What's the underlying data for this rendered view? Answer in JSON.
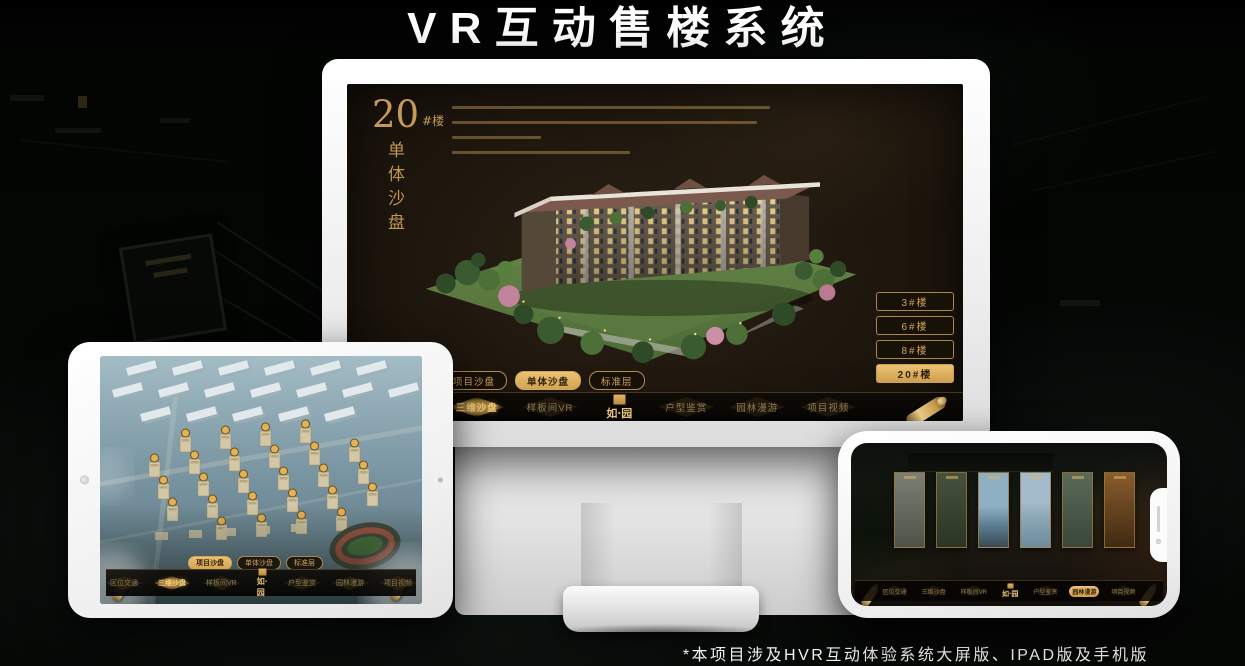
{
  "title": "VR互动售楼系统",
  "footnote": "*本项目涉及HVR互动体验系统大屏版、IPAD版及手机版",
  "logo_text": "如·园",
  "accent_color": "#d2a659",
  "icons": {
    "nav_end": "scroll-icon",
    "brand": "seal-icon",
    "tablet_front": "camera-icon",
    "phone_notch": "speaker-and-camera"
  },
  "monitor": {
    "headline_number": "20",
    "headline_unit": "#楼",
    "headline_subtitle": "单体沙盘",
    "floor_buttons": [
      {
        "label": "3#楼",
        "selected": false
      },
      {
        "label": "6#楼",
        "selected": false
      },
      {
        "label": "8#楼",
        "selected": false
      },
      {
        "label": "20#楼",
        "selected": true
      }
    ],
    "sub_tabs": [
      {
        "label": "项目沙盘",
        "selected": false
      },
      {
        "label": "单体沙盘",
        "selected": true
      },
      {
        "label": "标准层",
        "selected": false
      }
    ],
    "nav_left": [
      {
        "label": "区位交通",
        "selected": false
      },
      {
        "label": "三维沙盘",
        "selected": true
      },
      {
        "label": "样板间VR",
        "selected": false
      }
    ],
    "nav_right": [
      {
        "label": "户型鉴赏",
        "selected": false
      },
      {
        "label": "园林漫游",
        "selected": false
      },
      {
        "label": "项目视频",
        "selected": false
      }
    ]
  },
  "tablet": {
    "sub_tabs": [
      {
        "label": "项目沙盘",
        "selected": true
      },
      {
        "label": "单体沙盘",
        "selected": false
      },
      {
        "label": "标准层",
        "selected": false
      }
    ],
    "nav_left": [
      {
        "label": "区位交通",
        "selected": false
      },
      {
        "label": "三维沙盘",
        "selected": true
      },
      {
        "label": "样板间VR",
        "selected": false
      }
    ],
    "nav_right": [
      {
        "label": "户型鉴赏",
        "selected": false
      },
      {
        "label": "园林漫游",
        "selected": false
      },
      {
        "label": "项目视频",
        "selected": false
      }
    ]
  },
  "phone": {
    "nav_left": [
      {
        "label": "区位交通",
        "selected": false
      },
      {
        "label": "三维沙盘",
        "selected": false
      },
      {
        "label": "样板间VR",
        "selected": false
      }
    ],
    "nav_right": [
      {
        "label": "户型鉴赏",
        "selected": false
      },
      {
        "label": "园林漫游",
        "selected": true
      },
      {
        "label": "项目视频",
        "selected": false
      }
    ]
  }
}
